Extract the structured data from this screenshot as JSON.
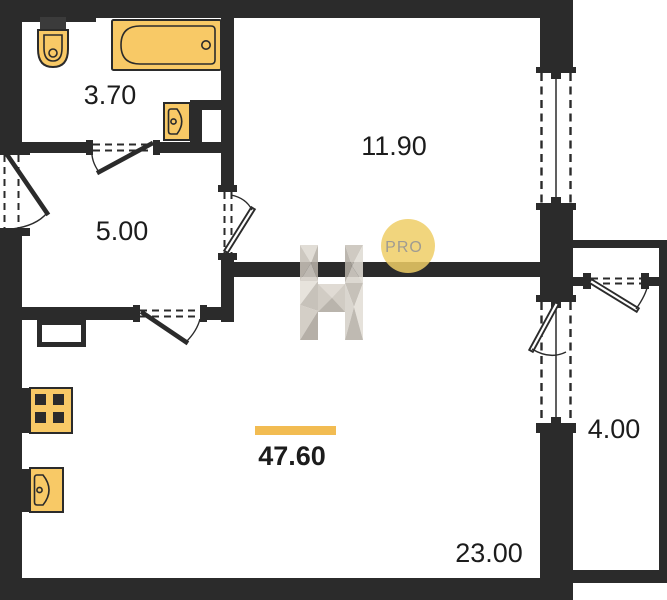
{
  "plan": {
    "logo": {
      "brand_letter": "H",
      "badge_label": "PRO"
    },
    "total": {
      "area": "47.60"
    },
    "rooms": {
      "bathroom": {
        "area": "3.70"
      },
      "room": {
        "area": "11.90"
      },
      "hall": {
        "area": "5.00"
      },
      "kitchen_living": {
        "area": "23.00"
      },
      "balcony": {
        "area": "4.00"
      }
    },
    "colors": {
      "wall": "#2b2b2b",
      "fixture_fill": "#f8c966",
      "accent_bar": "#f2bc52",
      "badge_fill": "#efce66",
      "badge_text": "#9f9b92",
      "label_text": "#1c1c1c"
    },
    "fixtures": [
      "bathtub",
      "toilet",
      "wash-basin",
      "stove",
      "kitchen-sink",
      "vent-duct"
    ]
  }
}
